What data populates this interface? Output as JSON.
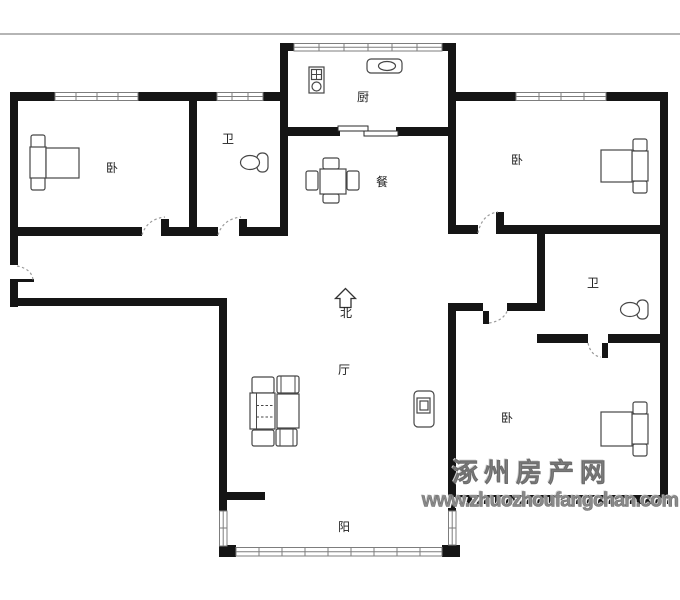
{
  "page": {
    "type": "apartment-floor-plan"
  },
  "rooms": {
    "bedroom_top_left": {
      "label": "卧"
    },
    "bathroom_top": {
      "label": "卫"
    },
    "kitchen": {
      "label": "厨"
    },
    "dining": {
      "label": "餐"
    },
    "bedroom_top_right": {
      "label": "卧"
    },
    "bathroom_right": {
      "label": "卫"
    },
    "living": {
      "label": "厅"
    },
    "bedroom_bottom_right": {
      "label": "卧"
    },
    "balcony": {
      "label": "阳"
    }
  },
  "compass": {
    "north_label": "北",
    "icon": "north-arrow-icon"
  },
  "watermark": {
    "site_name": "涿州房产网",
    "site_url": "www.zhuozhoufangchan.com"
  },
  "icons": [
    "bed-icon",
    "toilet-icon",
    "stove-icon",
    "sink-icon",
    "dining-table-icon",
    "sofa-set-icon",
    "tv-cabinet-icon",
    "north-arrow-icon"
  ],
  "colors": {
    "wall": "#151515",
    "furniture_line": "#474747",
    "window_line": "#7d7d7d",
    "door_arc": "#9a9a9a",
    "top_border": "#b5b5b5",
    "watermark": "#8a8a8a",
    "label": "#1c1c1c",
    "background": "#ffffff"
  }
}
